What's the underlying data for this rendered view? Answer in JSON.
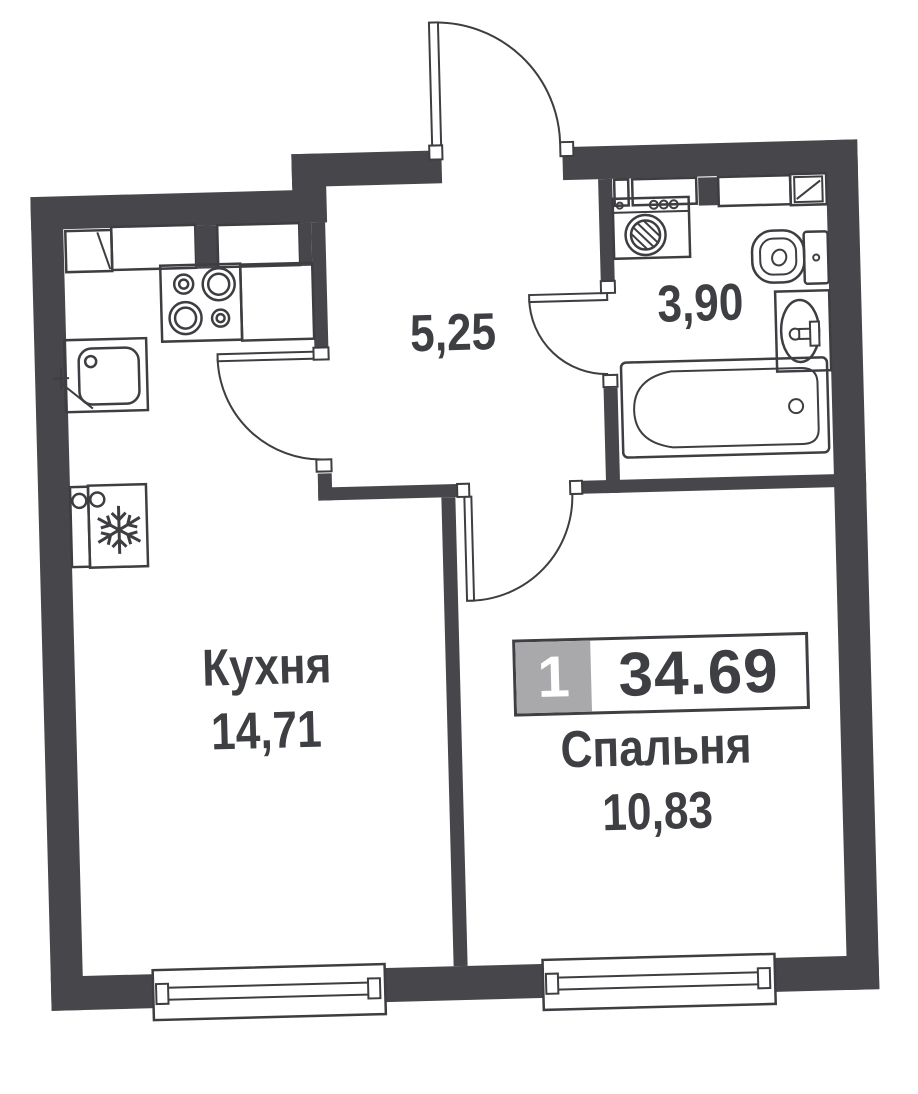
{
  "floorplan": {
    "badge": {
      "rooms_count": "1",
      "total_area": "34.69"
    },
    "rooms": {
      "hall": {
        "area": "5,25"
      },
      "bathroom": {
        "area": "3,90"
      },
      "kitchen": {
        "label": "Кухня",
        "area": "14,71"
      },
      "bedroom": {
        "label": "Спальня",
        "area": "10,83"
      }
    },
    "legend_symbols": [
      "entrance-door-arc",
      "kitchen-door-arc",
      "bedroom-door-arc",
      "bathroom-door-arc",
      "stove-icon",
      "kitchen-sink-icon",
      "fridge-snowflake-icon",
      "kitchen-cabinets",
      "washing-machine-icon",
      "toilet-icon",
      "washbasin-icon",
      "bathtub-icon",
      "window-kitchen",
      "window-bedroom"
    ],
    "colors": {
      "wall": "#47474b",
      "line": "#3e3e42",
      "text": "#3e3f43",
      "badge_gray": "#a9a9ab",
      "background": "#ffffff"
    }
  }
}
